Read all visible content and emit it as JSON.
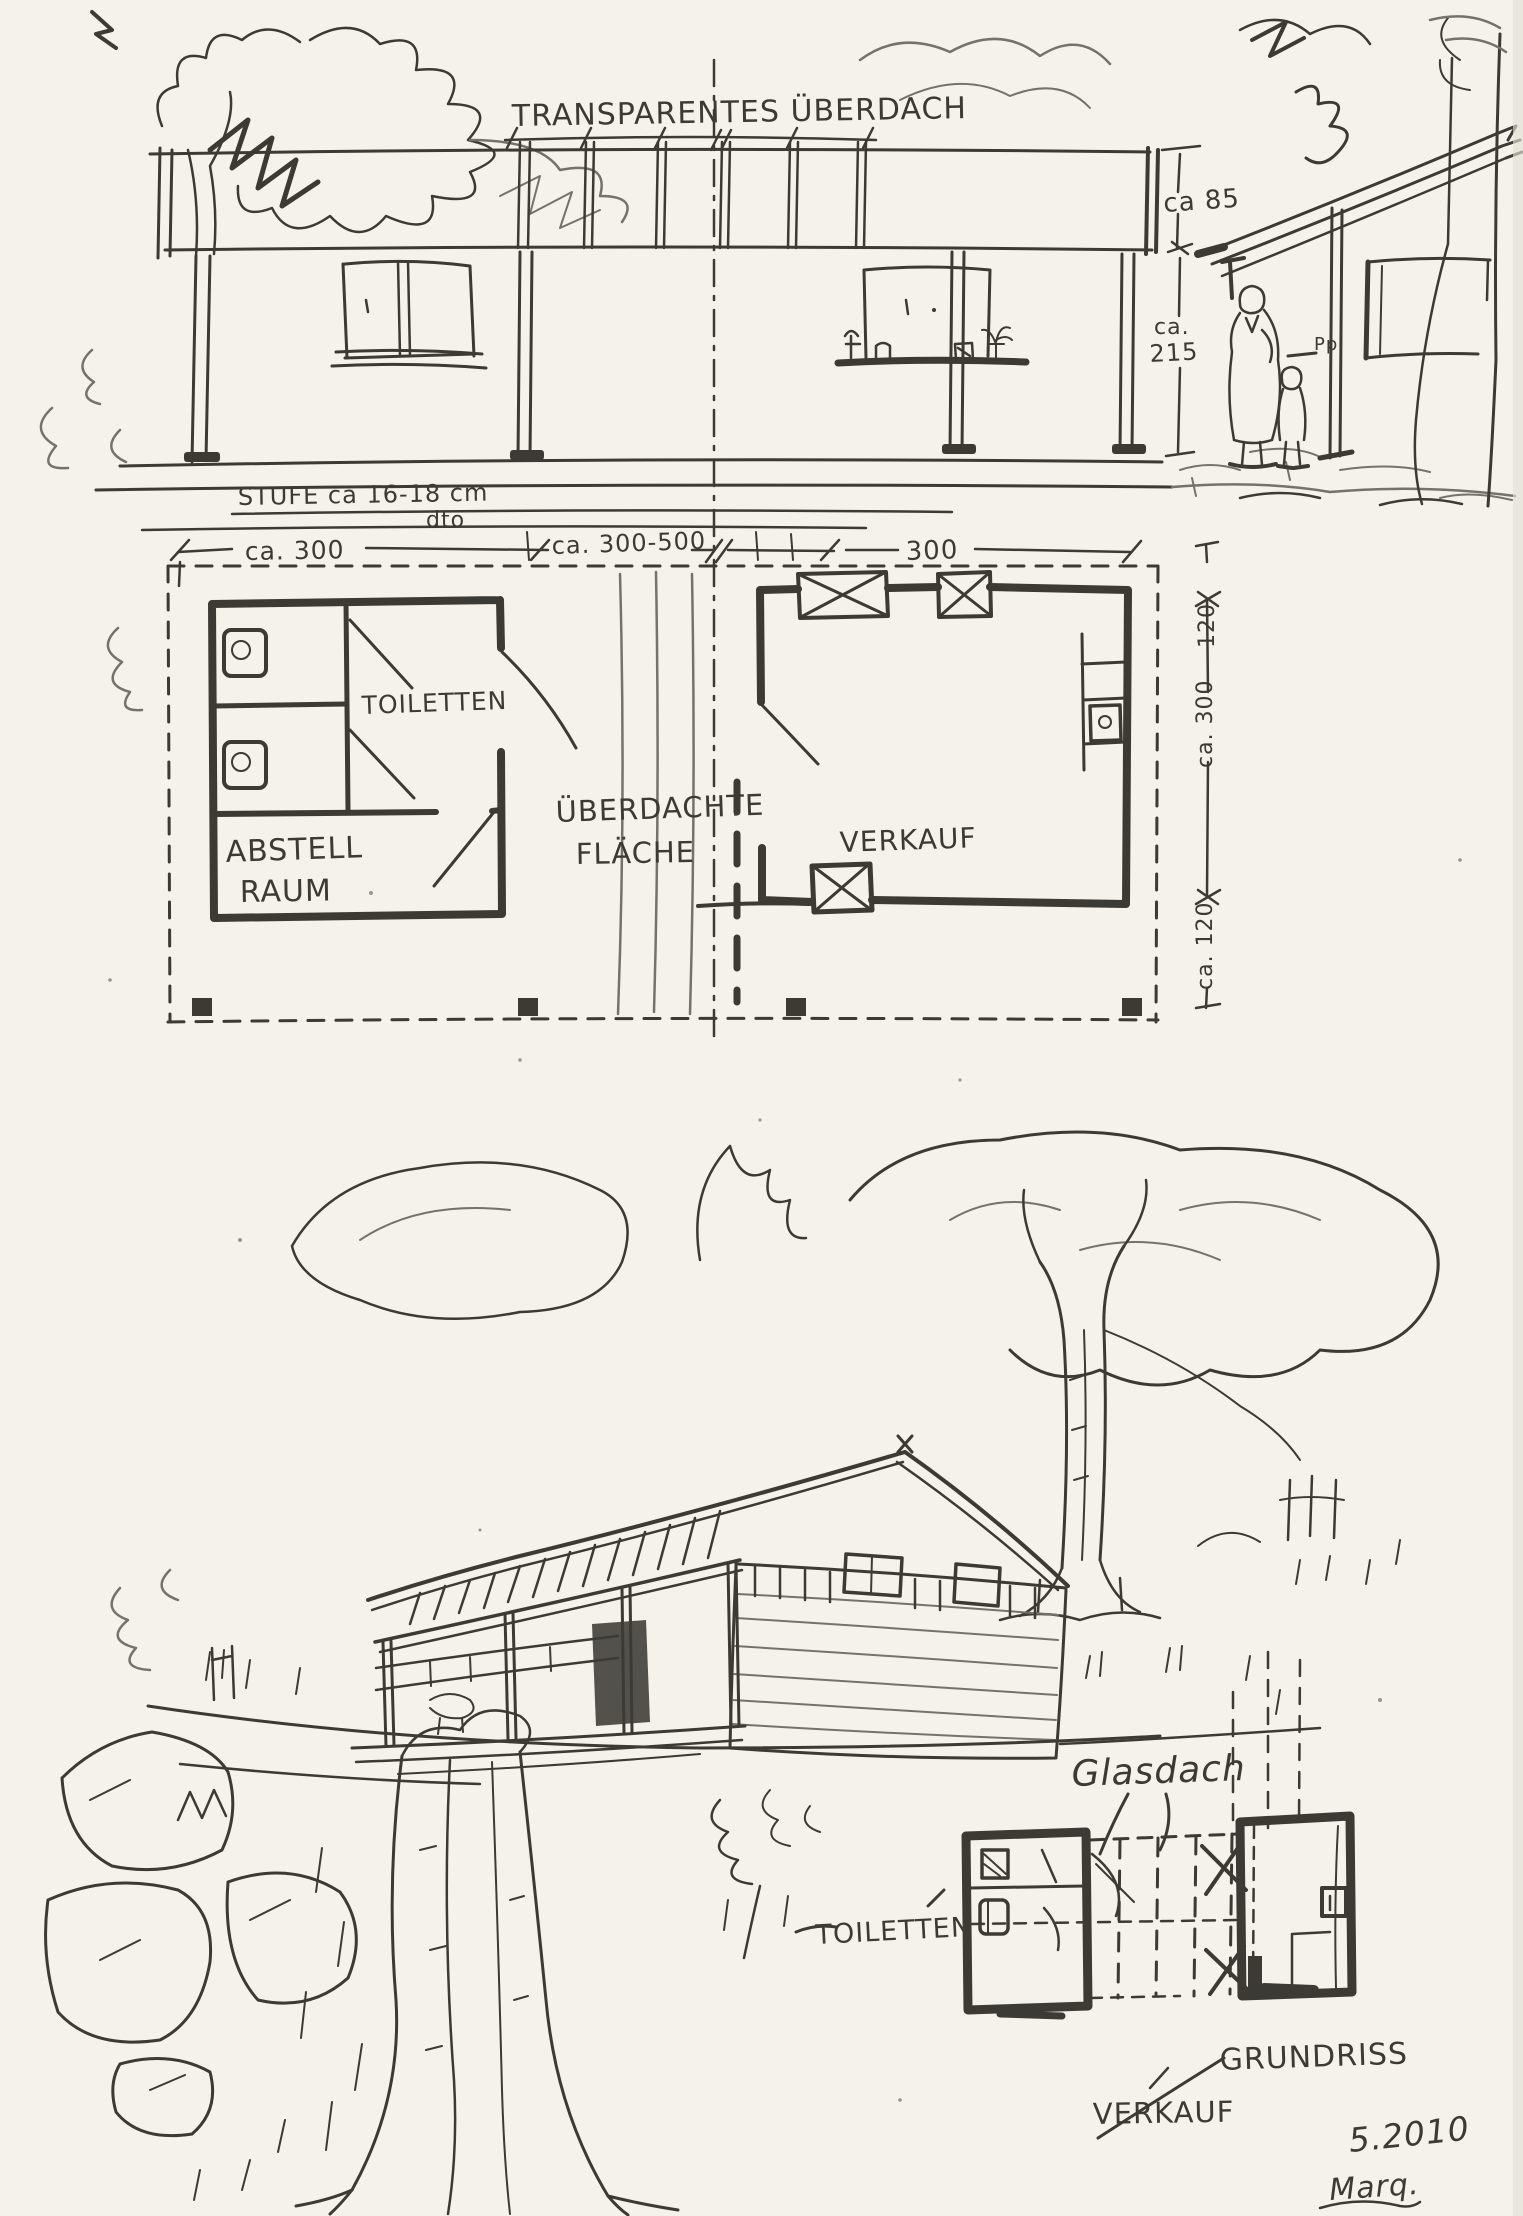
{
  "colors": {
    "paper": "#f4f2ea",
    "ink": "#3c3a35",
    "ink_light": "#75726a"
  },
  "elevation": {
    "canopy_label": "TRANSPARENTES ÜBERDACH",
    "dim_fascia": "ca 85",
    "dim_wall_line1": "ca.",
    "dim_wall_line2": "215",
    "step_note": "STUFE ca 16-18 cm",
    "step_ditto": "dto",
    "post_sign": "Pp"
  },
  "floor_plan": {
    "dim_top_left": "ca. 300",
    "dim_top_middle": "ca. 300-500",
    "dim_top_right": "300",
    "dim_side_top": "120",
    "dim_side_middle": "ca. 300",
    "dim_side_bottom": "ca. 120",
    "room_toilets": "TOILETTEN",
    "room_storage_line1": "ABSTELL",
    "room_storage_line2": "RAUM",
    "area_covered_line1": "ÜBERDACHTE",
    "area_covered_line2": "FLÄCHE",
    "room_sales": "VERKAUF"
  },
  "perspective": {
    "glass_roof": "Glasdach",
    "toilets": "TOILETTEN",
    "plan_title": "GRUNDRISS",
    "sales": "VERKAUF"
  },
  "footer": {
    "date": "5.2010",
    "signature": "Marq."
  }
}
